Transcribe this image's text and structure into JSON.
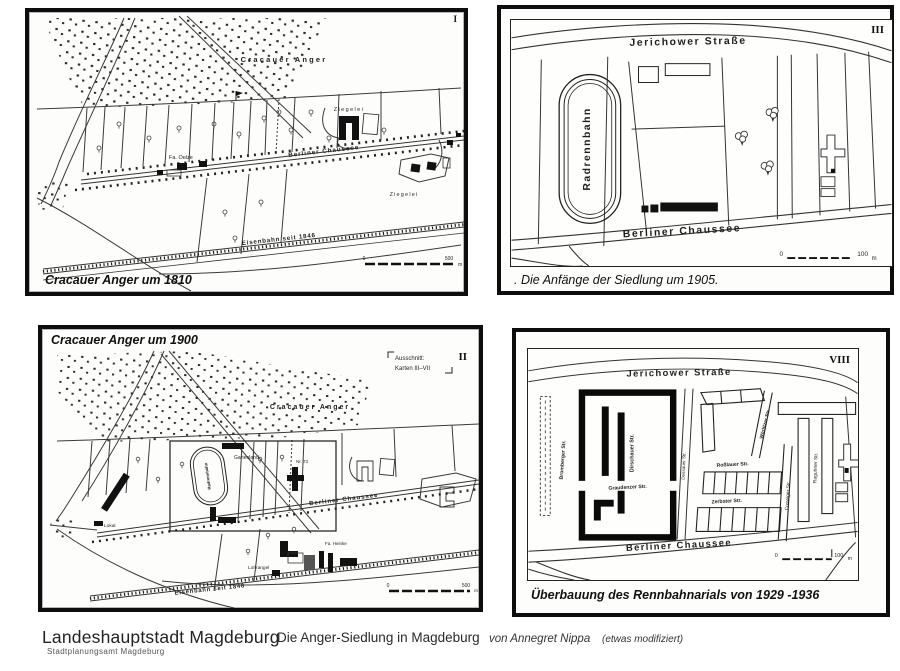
{
  "colors": {
    "ink": "#1a1a1a",
    "paper": "#ffffff",
    "frame": "#0d0d0d"
  },
  "footer": {
    "org": "Landeshauptstadt Magdeburg",
    "dept": "Stadtplanungsamt  Magdeburg",
    "title": "Die Anger-Siedlung in Magdeburg",
    "author": "von Annegret Nippa",
    "note": "(etwas modifiziert)"
  },
  "panels": {
    "p1": {
      "numeral": "I",
      "caption": "Cracauer Anger um 1810",
      "labels": {
        "anger": "Cracauer Anger",
        "ziegelei_top": "Ziegelei",
        "fa_oelze": "Fa. Oelze",
        "chaussee": "Berliner Chaussee",
        "ziegelei_bottom": "Ziegelei",
        "eisenbahn": "Eisenbahn seit 1846"
      },
      "scale": {
        "zero": "0",
        "end": "500",
        "unit": "m"
      }
    },
    "p3": {
      "numeral": "III",
      "caption": ". Die Anfänge der Siedlung um  1905.",
      "labels": {
        "jerichower": "Jerichower Straße",
        "radrennbahn": "Radrennbahn",
        "chaussee": "Berliner Chaussee"
      },
      "scale": {
        "zero": "0",
        "end": "100",
        "unit": "m"
      }
    },
    "p2": {
      "numeral": "II",
      "title": "Cracauer Anger um 1900",
      "legend_line1": "Ausschnitt:",
      "legend_line2": "Karten III–VII",
      "labels": {
        "anger": "Cracauer Anger",
        "radrennbahn": "Radrennbahn",
        "gartenland": "Gartenland",
        "chaussee": "Berliner Chaussee",
        "nr73": "Nr. 73",
        "lokal": "Lokal",
        "fa_heinke": "Fa. Heinke",
        "lohrangel": "Lohrangel",
        "eisenbahn": "Eisenbahn seit 1846"
      },
      "scale": {
        "zero": "0",
        "end": "500",
        "unit": "m"
      }
    },
    "p8": {
      "numeral": "VIII",
      "caption": "Überbauung des Rennbahnarials von 1929 -1936",
      "labels": {
        "jerichower": "Jerichower Straße",
        "chaussee": "Berliner Chaussee",
        "bromberger": "Bromberger Str.",
        "dirschauer": "Dirschauer Str.",
        "graudenzer": "Graudenzer Str.",
        "dessauer": "Dessauer Str.",
        "woerlitzer": "Wörlitzer Str.",
        "rosslauer": "Roßlauer Str.",
        "zerbster": "Zerbster Str.",
        "coswiger": "Coswiger Str.",
        "raguhner": "Raguhner Str."
      },
      "scale": {
        "zero": "0",
        "end": "100",
        "unit": "m"
      }
    }
  }
}
